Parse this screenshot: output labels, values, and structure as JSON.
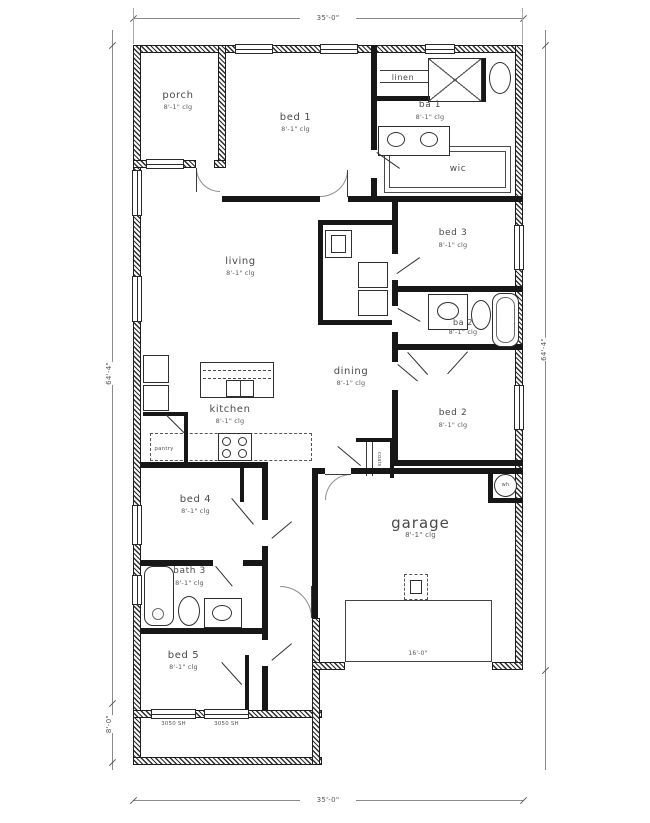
{
  "page": {
    "background": "#ffffff",
    "wall_color": "#171717"
  },
  "dimensions": {
    "top": "35'-0\"",
    "bottom": "35'-0\"",
    "left_main": "64'-4\"",
    "left_porch": "8'-0\"",
    "right": "64'-4\"",
    "garage_door": "16'-0\""
  },
  "rooms": {
    "porch": {
      "label": "porch",
      "clg": "8'-1\" clg"
    },
    "bed1": {
      "label": "bed 1",
      "clg": "8'-1\" clg"
    },
    "linen": {
      "label": "linen"
    },
    "ba1": {
      "label": "ba 1",
      "clg": "8'-1\" clg"
    },
    "wic": {
      "label": "wic"
    },
    "living": {
      "label": "living",
      "clg": "8'-1\" clg"
    },
    "bed3": {
      "label": "bed 3",
      "clg": "8'-1\" clg"
    },
    "ba2": {
      "label": "ba 2",
      "clg": "8'-1\" clg"
    },
    "dining": {
      "label": "dining",
      "clg": "8'-1\" clg"
    },
    "kitchen": {
      "label": "kitchen",
      "clg": "8'-1\" clg"
    },
    "pantry": {
      "label": "pantry"
    },
    "coats": {
      "label": "coats"
    },
    "bed2": {
      "label": "bed 2",
      "clg": "8'-1\" clg"
    },
    "bed4": {
      "label": "bed 4",
      "clg": "8'-1\" clg"
    },
    "bath3": {
      "label": "bath 3",
      "clg": "8'-1\" clg"
    },
    "bed5": {
      "label": "bed 5",
      "clg": "8'-1\" clg"
    },
    "garage": {
      "label": "garage",
      "clg": "8'-1\" clg"
    },
    "wh": {
      "label": "wh"
    }
  },
  "windows": {
    "bed5_left": "3050 SH",
    "bed5_right": "3050 SH"
  }
}
